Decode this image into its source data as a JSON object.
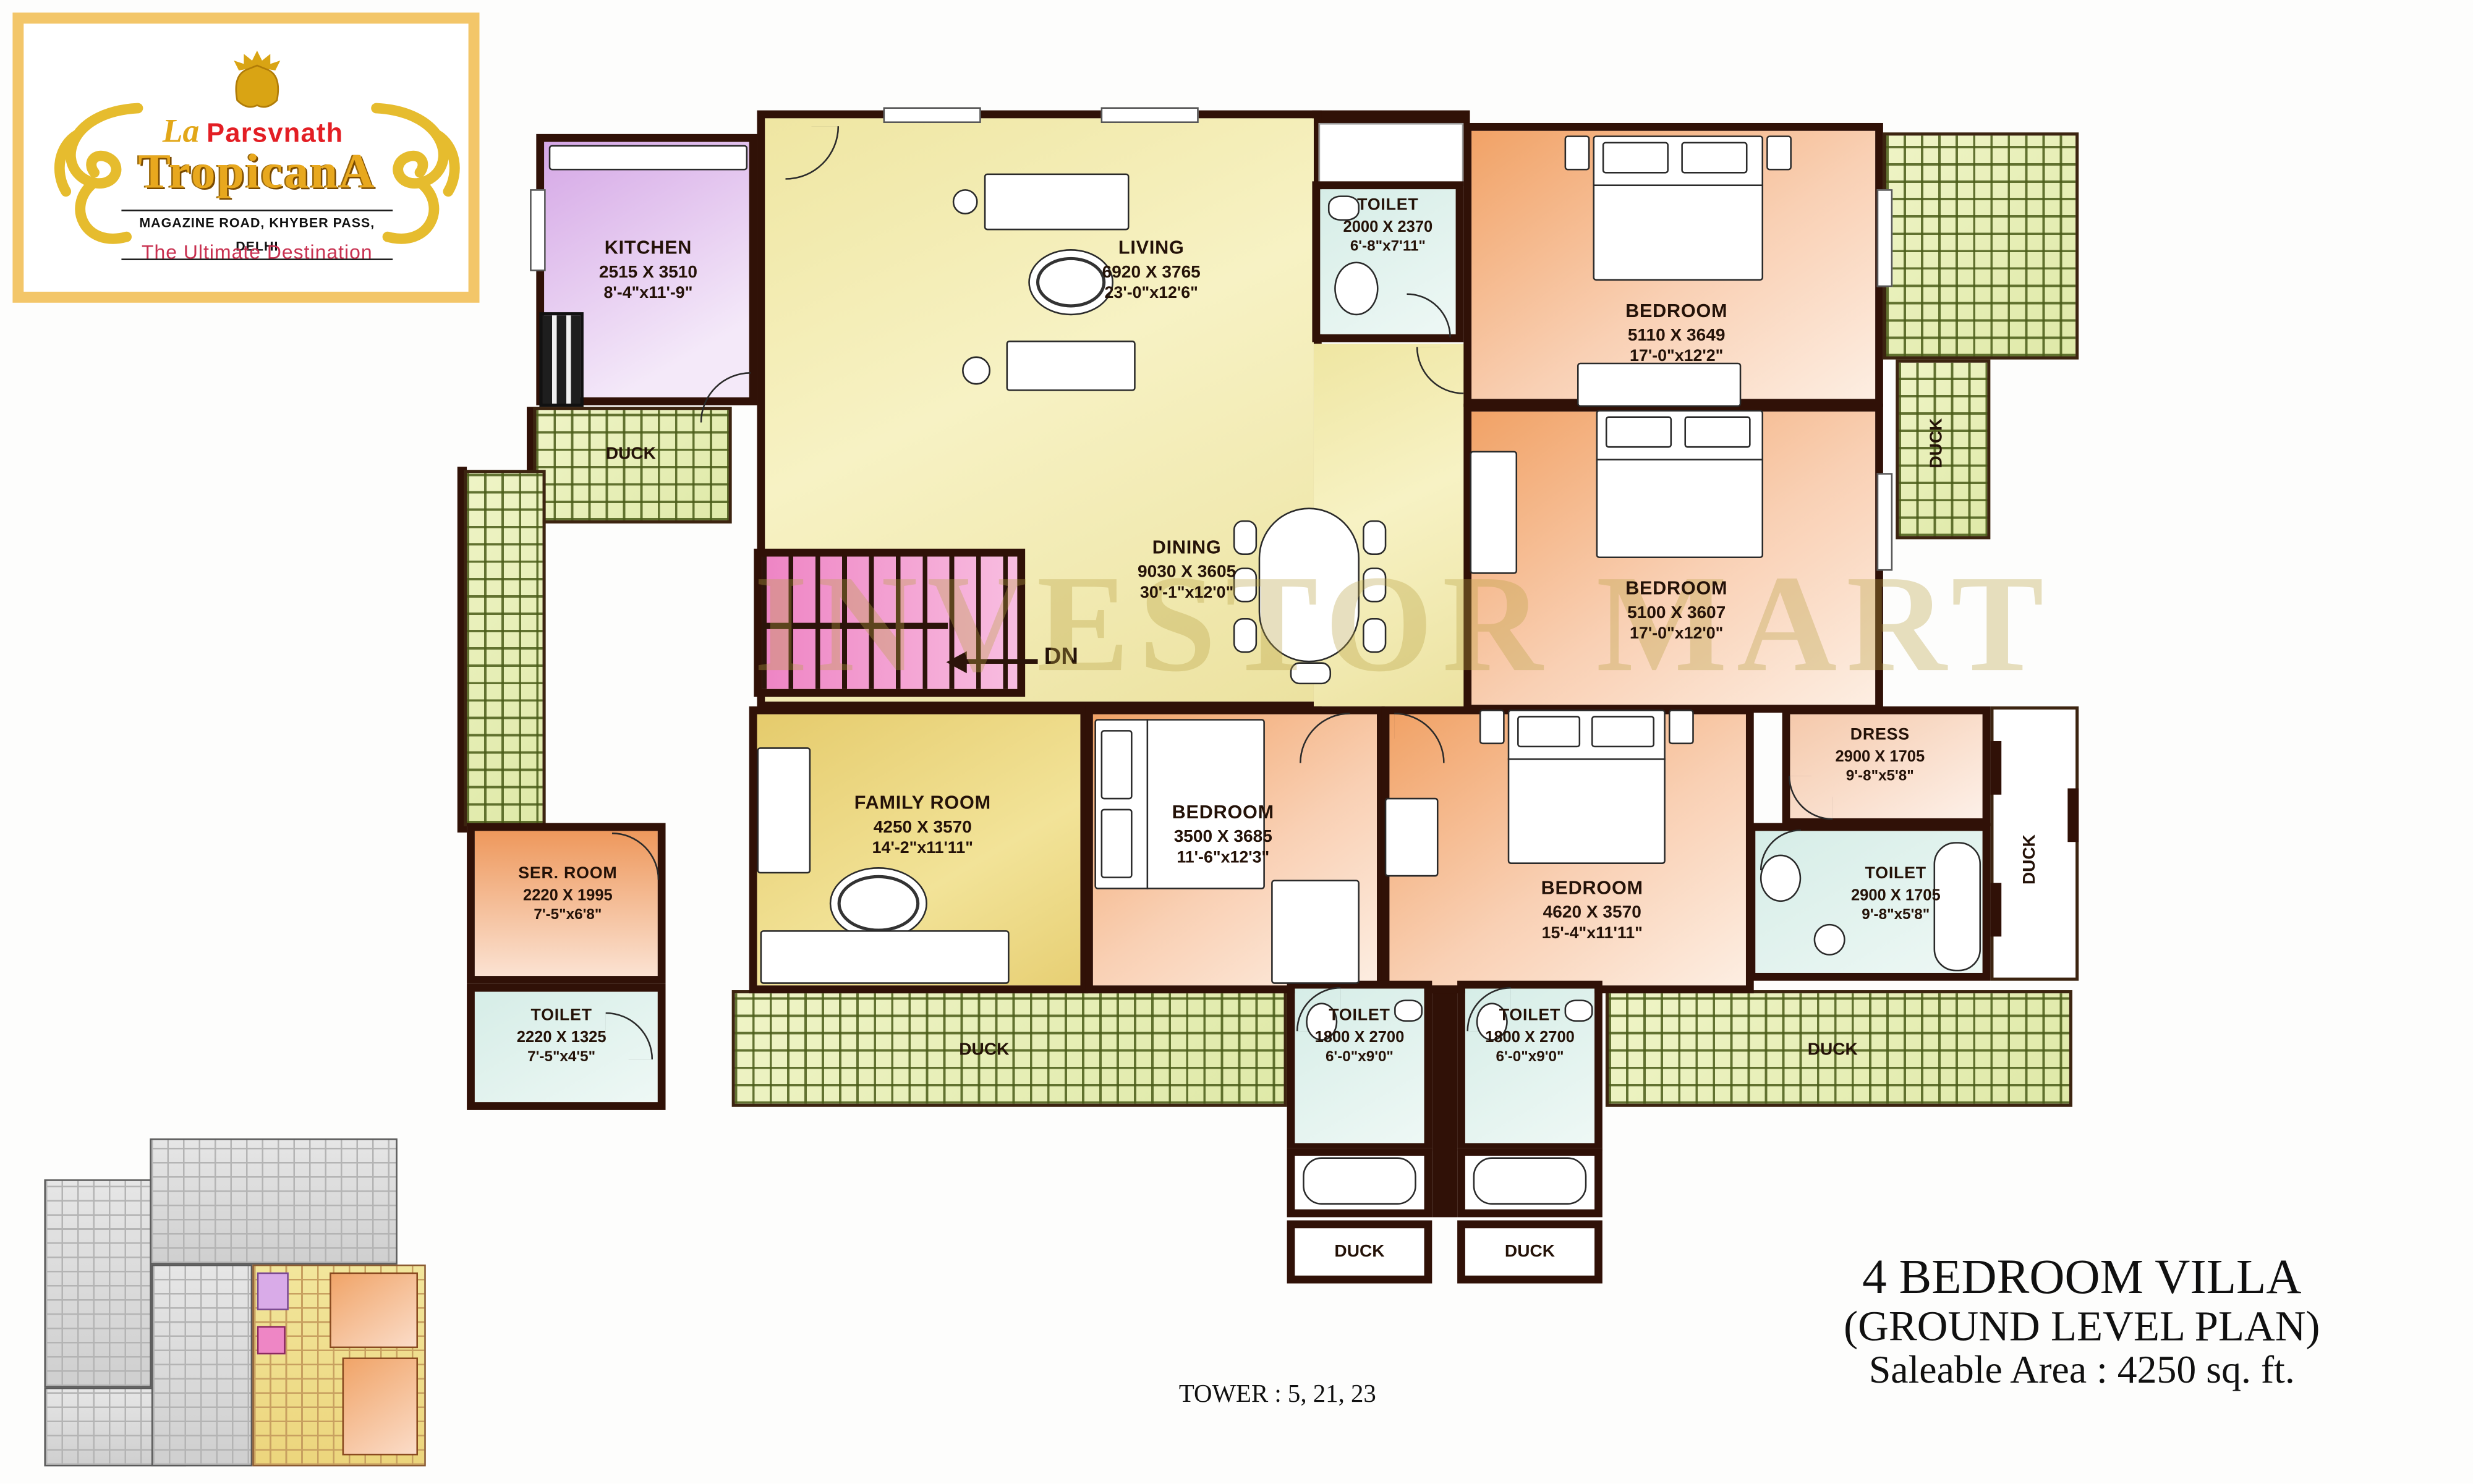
{
  "logo": {
    "brand_prefix": "La",
    "brand_top": "Parsvnath",
    "brand_name": "TropicanA",
    "address": "MAGAZINE ROAD, KHYBER PASS, DELHI",
    "tagline": "The Ultimate Destination"
  },
  "plan": {
    "watermark": "INVESTOR MART",
    "tower_note": "TOWER : 5, 21, 23",
    "stairs": "DN",
    "duct": "DUCK"
  },
  "title_block": {
    "line1": "4 BEDROOM VILLA",
    "line2": "(GROUND LEVEL PLAN)",
    "line3": "Saleable Area : 4250 sq. ft."
  },
  "rooms": {
    "kitchen": {
      "name": "KITCHEN",
      "mm": "2515 X 3510",
      "ft": "8'-4\"x11'-9\""
    },
    "living": {
      "name": "LIVING",
      "mm": "6920 X 3765",
      "ft": "23'-0\"x12'6\""
    },
    "dining": {
      "name": "DINING",
      "mm": "9030 X 3605",
      "ft": "30'-1\"x12'0\""
    },
    "toilet_top": {
      "name": "TOILET",
      "mm": "2000 X 2370",
      "ft": "6'-8\"x7'11\""
    },
    "bedroom1": {
      "name": "BEDROOM",
      "mm": "5110 X 3649",
      "ft": "17'-0\"x12'2\""
    },
    "bedroom2": {
      "name": "BEDROOM",
      "mm": "5100 X 3607",
      "ft": "17'-0\"x12'0\""
    },
    "bedroom3": {
      "name": "BEDROOM",
      "mm": "3500 X 3685",
      "ft": "11'-6\"x12'3\""
    },
    "bedroom4": {
      "name": "BEDROOM",
      "mm": "4620 X 3570",
      "ft": "15'-4\"x11'11\""
    },
    "family": {
      "name": "FAMILY ROOM",
      "mm": "4250 X 3570",
      "ft": "14'-2\"x11'11\""
    },
    "ser_room": {
      "name": "SER. ROOM",
      "mm": "2220 X 1995",
      "ft": "7'-5\"x6'8\""
    },
    "toilet_left": {
      "name": "TOILET",
      "mm": "2220 X 1325",
      "ft": "7'-5\"x4'5\""
    },
    "dress": {
      "name": "DRESS",
      "mm": "2900 X 1705",
      "ft": "9'-8\"x5'8\""
    },
    "toilet_right": {
      "name": "TOILET",
      "mm": "2900 X 1705",
      "ft": "9'-8\"x5'8\""
    },
    "toilet_b1": {
      "name": "TOILET",
      "mm": "1800 X 2700",
      "ft": "6'-0\"x9'0\""
    },
    "toilet_b2": {
      "name": "TOILET",
      "mm": "1800 X 2700",
      "ft": "6'-0\"x9'0\""
    }
  },
  "colors": {
    "wall": "#301107",
    "living_fill": "#f3ecb0",
    "family_fill": "#ecd57c",
    "bedroom_fill": "#f2a76d",
    "kitchen_fill": "#d9abe8",
    "toilet_fill": "#d9eee9",
    "stairs_fill": "#ee86c5",
    "balcony_hatch": "#e8efb6",
    "logo_gold": "#e2a718",
    "brand_red": "#e31e24",
    "tagline_red": "#c83050"
  }
}
